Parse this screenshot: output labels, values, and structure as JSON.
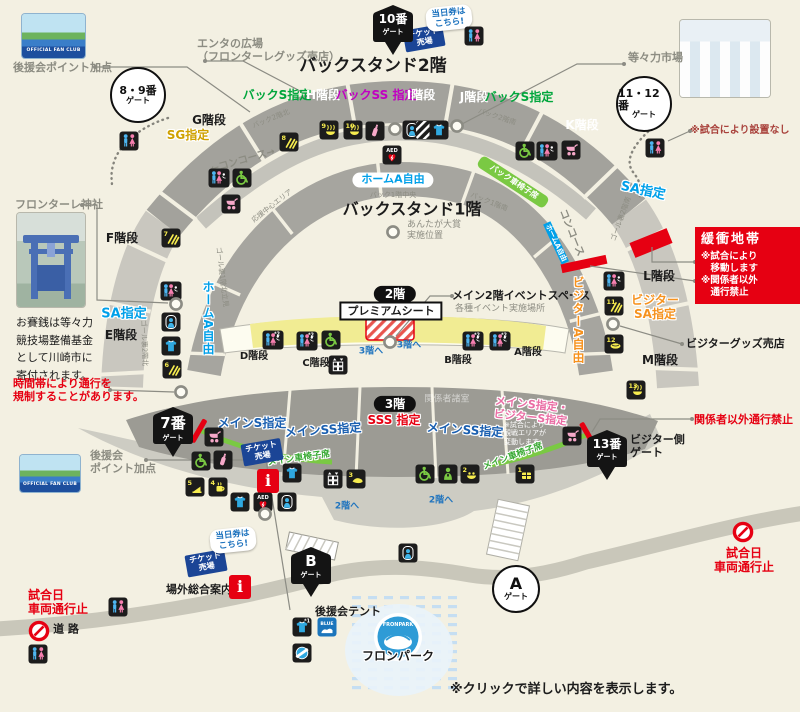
{
  "colors": {
    "bg": "#f3f0e2",
    "gray": "#8c8c82",
    "black": "#1c1c1c",
    "red": "#e60012",
    "dred": "#a8403a",
    "green": "#00a63c",
    "wgreen": "#3aaa35",
    "mag": "#c100c1",
    "cyan": "#00a0e9",
    "orange": "#f6921e",
    "gold": "#cfa100",
    "blue": "#1a5fb0",
    "pink": "#ea6da4",
    "blue2": "#1e73be",
    "stand_gray": "#a3a29c",
    "stand_light": "#c9c7bf",
    "seat_yellow": "#f1ec93",
    "wheelchair_green": "#7ac943",
    "road": "#c9c7ba",
    "park_blue": "#c5def2"
  },
  "buffer": {
    "title": "緩衝地帯",
    "line1": "※試合により",
    "line2": "　移動します",
    "line3": "※関係者以外",
    "line4": "　通行禁止"
  },
  "photos": {
    "fanclub": "OFFICIAL FAN CLUB",
    "fronpark": "FRONPARK"
  },
  "gates": [
    {
      "shape": "shield",
      "l1": "10番",
      "l2": "ゲート",
      "x": 393,
      "y": 31
    },
    {
      "shape": "shield",
      "l1": "7番",
      "l2": "ゲート",
      "x": 173,
      "y": 433
    },
    {
      "shape": "shield",
      "l1": "13番",
      "l2": "ゲート",
      "x": 607,
      "y": 456
    },
    {
      "shape": "shield",
      "l1": "B",
      "l2": "ゲート",
      "x": 311,
      "y": 573
    },
    {
      "shape": "circle",
      "l1": "8・9番",
      "l2": "ゲート",
      "x": 138,
      "y": 95,
      "r": 26
    },
    {
      "shape": "circle",
      "l1": "11・12番",
      "l2": "ゲート",
      "x": 644,
      "y": 104,
      "r": 26
    },
    {
      "shape": "circle",
      "l1": "A",
      "l2": "ゲート",
      "x": 516,
      "y": 589,
      "r": 22
    }
  ],
  "labels": [
    {
      "t": "エンタの広場\n（フロンターレグッズ売店）",
      "x": 197,
      "y": 38,
      "cls": "gray s11 b tl",
      "n": "enta-plaza-label"
    },
    {
      "t": "後援会ポイント加点",
      "x": 13,
      "y": 62,
      "cls": "gray s11 b tl",
      "n": "fanclub-point-label"
    },
    {
      "t": "後援会\nポイント加点",
      "x": 90,
      "y": 450,
      "cls": "gray s11 b tl",
      "n": "fanclub-point-label"
    },
    {
      "t": "バックスタンド2階",
      "x": 373,
      "y": 66,
      "cls": "black s17 b",
      "n": "backstand-2f-title"
    },
    {
      "t": "バックスタンド1階",
      "x": 412,
      "y": 210,
      "cls": "black s16 b",
      "n": "backstand-1f-title"
    },
    {
      "t": "バックS指定",
      "x": 277,
      "y": 95,
      "cls": "green s12 b",
      "n": "seat-back-s"
    },
    {
      "t": "H階段",
      "x": 323,
      "y": 95,
      "cls": "white s12 b",
      "n": "stairs-h"
    },
    {
      "t": "バックSS 指定",
      "x": 376,
      "y": 95,
      "cls": "mag s12 b",
      "n": "seat-back-ss"
    },
    {
      "t": "I階段",
      "x": 421,
      "y": 95,
      "cls": "white s12 b",
      "n": "stairs-i"
    },
    {
      "t": "J階段",
      "x": 474,
      "y": 97,
      "cls": "white s12 b",
      "n": "stairs-j"
    },
    {
      "t": "バックS指定",
      "x": 519,
      "y": 97,
      "cls": "green s12 b",
      "n": "seat-back-s"
    },
    {
      "t": "G階段",
      "x": 209,
      "y": 120,
      "cls": "black s12 b",
      "n": "stairs-g"
    },
    {
      "t": "SG指定",
      "x": 188,
      "y": 135,
      "cls": "gold s12 b halo",
      "n": "seat-sg"
    },
    {
      "t": "K階段",
      "x": 582,
      "y": 125,
      "cls": "white s12 b",
      "n": "stairs-k"
    },
    {
      "t": "F階段",
      "x": 122,
      "y": 238,
      "cls": "black s12 b",
      "n": "stairs-f"
    },
    {
      "t": "E階段",
      "x": 121,
      "y": 335,
      "cls": "black s12 b",
      "n": "stairs-e"
    },
    {
      "t": "SA指定",
      "x": 124,
      "y": 314,
      "cls": "cyan s13 b halo",
      "n": "seat-sa"
    },
    {
      "t": "SA指定",
      "x": 643,
      "y": 191,
      "cls": "cyan s13 b halo",
      "r": 12,
      "n": "seat-sa"
    },
    {
      "t": "L階段",
      "x": 659,
      "y": 276,
      "cls": "black s12 b",
      "n": "stairs-l"
    },
    {
      "t": "ビジター\nSA指定",
      "x": 655,
      "y": 307,
      "cls": "orange s12 b halo",
      "n": "seat-visitor-sa"
    },
    {
      "t": "M階段",
      "x": 660,
      "y": 360,
      "cls": "black s12 b",
      "n": "stairs-m"
    },
    {
      "t": "ビジターグッズ売店",
      "x": 686,
      "y": 338,
      "cls": "black s11 b tl",
      "n": "visitor-goods-shop-label"
    },
    {
      "t": "等々力市場",
      "x": 628,
      "y": 52,
      "cls": "gray s11 b tl",
      "n": "todoroki-market-label"
    },
    {
      "t": "※試合により設置なし",
      "x": 690,
      "y": 125,
      "cls": "dred s10 b tl",
      "n": "note-no-setup"
    },
    {
      "t": "フロンターレ神社",
      "x": 15,
      "y": 199,
      "cls": "gray s11 b tl",
      "n": "frontale-shrine-label"
    },
    {
      "t": "お賽銭は等々力\n競技場整備基金\nとして川崎市に\n寄付されます。",
      "x": 16,
      "y": 314,
      "cls": "black s11 tl lh16",
      "n": "shrine-donation-note"
    },
    {
      "t": "時間帯により通行を\n規制することがあります。",
      "x": 13,
      "y": 378,
      "cls": "red s11 b tl",
      "n": "traffic-restriction-note"
    },
    {
      "t": "あんたが大賞\n実施位置",
      "x": 407,
      "y": 220,
      "cls": "gray s9 tl",
      "n": "anta-taisho-label"
    },
    {
      "t": "ホームA自由",
      "x": 393,
      "y": 180,
      "cls": "cyan s11 b pill",
      "n": "seat-home-a-free"
    },
    {
      "t": "バック1階中央",
      "x": 393,
      "y": 195,
      "cls": "gray s7",
      "n": "area-back1f-center"
    },
    {
      "t": "バック2階北",
      "x": 271,
      "y": 119,
      "cls": "gray s7",
      "r": -22,
      "n": "area-back2f-north"
    },
    {
      "t": "バック2階南",
      "x": 497,
      "y": 117,
      "cls": "gray s7",
      "r": 18,
      "n": "area-back2f-south"
    },
    {
      "t": "バック1階南",
      "x": 489,
      "y": 202,
      "cls": "gray s7",
      "r": 22,
      "n": "area-back1f-south"
    },
    {
      "t": "応援中心エリア",
      "x": 272,
      "y": 206,
      "cls": "gray s7",
      "r": -38,
      "n": "area-cheering"
    },
    {
      "t": "ゴール裏1階北立見",
      "x": 222,
      "y": 277,
      "cls": "gray s7",
      "r": 83,
      "n": "area-goal-north"
    },
    {
      "t": "ゴール裏2階北",
      "x": 144,
      "y": 343,
      "cls": "gray s7",
      "r": 88,
      "n": "area-goal-2f-north"
    },
    {
      "t": "ゴール裏2階南",
      "x": 621,
      "y": 219,
      "cls": "gray s7",
      "r": -70,
      "n": "area-goal-2f-south"
    },
    {
      "t": "←コンコース→",
      "x": 243,
      "y": 161,
      "cls": "gray s10 b",
      "r": -16,
      "n": "concourse-label"
    },
    {
      "t": "コンコース",
      "x": 571,
      "y": 233,
      "cls": "gray s10 b",
      "r": 68,
      "n": "concourse-label"
    },
    {
      "t": "バック車椅子席",
      "x": 514,
      "y": 182,
      "cls": "white s8 b",
      "r": 33,
      "n": "seat-back-wheelchair"
    },
    {
      "t": "2階",
      "x": 395,
      "y": 294,
      "cls": "s12 b pillblack",
      "n": "floor-2f-badge"
    },
    {
      "t": "プレミアムシート",
      "x": 391,
      "y": 311,
      "cls": "black s11 b boxwhite",
      "n": "premium-seat-label"
    },
    {
      "t": "メイン2階イベントスペース",
      "x": 452,
      "y": 290,
      "cls": "black s11 b tl",
      "n": "main2f-event-space-label"
    },
    {
      "t": "各種イベント実施場所",
      "x": 455,
      "y": 304,
      "cls": "gray s9 tl",
      "n": "event-place-note"
    },
    {
      "t": "D階段",
      "x": 254,
      "y": 357,
      "cls": "black s10 b",
      "n": "stairs-d"
    },
    {
      "t": "C階段",
      "x": 316,
      "y": 364,
      "cls": "black s10 b",
      "n": "stairs-c"
    },
    {
      "t": "B階段",
      "x": 458,
      "y": 361,
      "cls": "black s10 b",
      "n": "stairs-b"
    },
    {
      "t": "A階段",
      "x": 528,
      "y": 353,
      "cls": "black s10 b",
      "n": "stairs-a"
    },
    {
      "t": "3階へ",
      "x": 371,
      "y": 352,
      "cls": "blue2 s9 b",
      "n": "to-3f-label"
    },
    {
      "t": "3階へ",
      "x": 409,
      "y": 346,
      "cls": "blue2 s9 b",
      "n": "to-3f-label"
    },
    {
      "t": "3階",
      "x": 395,
      "y": 404,
      "cls": "s12 b pillblack",
      "n": "floor-3f-badge"
    },
    {
      "t": "関係者諸室",
      "x": 447,
      "y": 400,
      "cls": "white s9 fade",
      "n": "staff-rooms-label"
    },
    {
      "t": "メインS指定",
      "x": 252,
      "y": 423,
      "cls": "blue s12 b halo",
      "n": "seat-main-s"
    },
    {
      "t": "メインSS指定",
      "x": 323,
      "y": 430,
      "cls": "blue s12 b halo",
      "r": -4,
      "n": "seat-main-ss"
    },
    {
      "t": "SSS 指定",
      "x": 394,
      "y": 420,
      "cls": "red s12 b halo",
      "n": "seat-sss"
    },
    {
      "t": "メインSS指定",
      "x": 465,
      "y": 430,
      "cls": "blue s12 b halo",
      "r": 4,
      "n": "seat-main-ss"
    },
    {
      "t": "メインS指定・\nビジターS指定",
      "x": 531,
      "y": 412,
      "cls": "pink s11 b halo",
      "r": 6,
      "n": "seat-main-s-visitor-s"
    },
    {
      "t": "※試合により\n観戦エリアが\n変動します。",
      "x": 504,
      "y": 421,
      "cls": "white s7 tl",
      "n": "note-area-changes"
    },
    {
      "t": "メイン車椅子席",
      "x": 299,
      "y": 459,
      "cls": "wgreen s9 b halo",
      "r": -8,
      "n": "seat-main-wheelchair"
    },
    {
      "t": "メイン車椅子席",
      "x": 513,
      "y": 457,
      "cls": "wgreen s9 b halo",
      "r": -20,
      "n": "seat-main-wheelchair"
    },
    {
      "t": "関係者以外通行禁止",
      "x": 694,
      "y": 414,
      "cls": "red s11 b tl",
      "n": "staff-only-note"
    },
    {
      "t": "ビジター側\nゲート",
      "x": 630,
      "y": 434,
      "cls": "black s11 b tl",
      "n": "visitor-gate-label"
    },
    {
      "t": "2階へ",
      "x": 347,
      "y": 507,
      "cls": "blue2 s9 b",
      "n": "to-2f-label"
    },
    {
      "t": "2階へ",
      "x": 441,
      "y": 501,
      "cls": "blue2 s9 b",
      "n": "to-2f-label"
    },
    {
      "t": "場外総合案内所",
      "x": 166,
      "y": 584,
      "cls": "black s11 b tl",
      "n": "info-center-label"
    },
    {
      "t": "後援会テント",
      "x": 315,
      "y": 606,
      "cls": "black s11 b tl",
      "n": "fanclub-tent-label"
    },
    {
      "t": "フロンパーク",
      "x": 398,
      "y": 656,
      "cls": "black s12 b halo",
      "n": "fronpark-label"
    },
    {
      "t": "FRONPARK",
      "x": 398,
      "y": 626,
      "cls": "white s5 b",
      "n": "fronpark-logo-text"
    },
    {
      "t": "※クリックで詳しい内容を表示します。",
      "x": 450,
      "y": 682,
      "cls": "black s13 b tl",
      "n": "click-note"
    },
    {
      "t": "試合日\n車両通行止",
      "x": 28,
      "y": 588,
      "cls": "red s12 b tl",
      "n": "matchday-road-closed"
    },
    {
      "t": "試合日\n車両通行止",
      "x": 744,
      "y": 560,
      "cls": "red s12 b",
      "n": "matchday-road-closed"
    },
    {
      "t": "道 路",
      "x": 66,
      "y": 630,
      "cls": "black s11 b",
      "n": "road-label"
    },
    {
      "t": "ホームA自由",
      "x": 208,
      "y": 318,
      "cls": "cyan s12 b vert halo",
      "n": "seat-home-a-free-side"
    },
    {
      "t": "ビジターA自由",
      "x": 578,
      "y": 320,
      "cls": "orange s12 b vert halo",
      "n": "seat-visitor-a-free-side"
    },
    {
      "t": "ホームA自由",
      "x": 556,
      "y": 243,
      "cls": "s7 b tagcyan",
      "r": 65,
      "n": "seat-home-a-free-tag"
    },
    {
      "t": "チケット\n売場",
      "x": 424,
      "y": 38,
      "cls": "badge-ticket",
      "r": -10,
      "n": "ticket-booth-badge"
    },
    {
      "t": "チケット\n売場",
      "x": 262,
      "y": 452,
      "cls": "badge-ticket",
      "r": -10,
      "n": "ticket-booth-badge"
    },
    {
      "t": "チケット\n売場",
      "x": 206,
      "y": 563,
      "cls": "badge-ticket",
      "r": -10,
      "n": "ticket-booth-badge"
    },
    {
      "t": "当日券は\nこちら!",
      "x": 449,
      "y": 18,
      "cls": "bubble",
      "r": -6,
      "n": "today-ticket-bubble"
    },
    {
      "t": "当日券は\nこちら!",
      "x": 233,
      "y": 540,
      "cls": "bubble",
      "r": -6,
      "n": "today-ticket-bubble"
    }
  ],
  "icons": [
    {
      "t": "toilet",
      "x": 474,
      "y": 36
    },
    {
      "t": "toilet",
      "x": 655,
      "y": 148
    },
    {
      "t": "toilet",
      "x": 129,
      "y": 141
    },
    {
      "t": "wc",
      "x": 219,
      "y": 178
    },
    {
      "t": "wheelchair",
      "x": 242,
      "y": 178
    },
    {
      "t": "stroller",
      "x": 231,
      "y": 204
    },
    {
      "t": "conc",
      "n": 7,
      "x": 171,
      "y": 238
    },
    {
      "t": "wc",
      "x": 171,
      "y": 291
    },
    {
      "t": "rescue",
      "x": 171,
      "y": 322
    },
    {
      "t": "shirt",
      "x": 171,
      "y": 346
    },
    {
      "t": "conc",
      "n": 6,
      "x": 172,
      "y": 369
    },
    {
      "t": "conc",
      "n": 8,
      "x": 289,
      "y": 142
    },
    {
      "t": "conc",
      "n": 9,
      "x": 329,
      "y": 130
    },
    {
      "t": "conc",
      "n": 10,
      "x": 353,
      "y": 130
    },
    {
      "t": "bottle",
      "x": 375,
      "y": 131
    },
    {
      "t": "rescue",
      "x": 412,
      "y": 130
    },
    {
      "t": "hatchsq",
      "x": 425,
      "y": 130
    },
    {
      "t": "shirt",
      "x": 439,
      "y": 130
    },
    {
      "t": "aed",
      "x": 392,
      "y": 155
    },
    {
      "t": "wheelchair",
      "x": 525,
      "y": 151
    },
    {
      "t": "wc",
      "x": 547,
      "y": 151
    },
    {
      "t": "stroller",
      "x": 571,
      "y": 150
    },
    {
      "t": "wc",
      "x": 614,
      "y": 281
    },
    {
      "t": "conc",
      "n": 11,
      "x": 614,
      "y": 306
    },
    {
      "t": "conc",
      "n": 12,
      "x": 614,
      "y": 344
    },
    {
      "t": "conc",
      "n": 13,
      "x": 636,
      "y": 390
    },
    {
      "t": "wc",
      "s": "2",
      "x": 273,
      "y": 340
    },
    {
      "t": "wc",
      "s": "2",
      "x": 307,
      "y": 341
    },
    {
      "t": "wheelchair",
      "x": 331,
      "y": 340
    },
    {
      "t": "locker",
      "x": 338,
      "y": 365
    },
    {
      "t": "wc",
      "s": "2",
      "x": 473,
      "y": 341
    },
    {
      "t": "wc",
      "s": "2",
      "x": 500,
      "y": 341
    },
    {
      "t": "stroller",
      "x": 214,
      "y": 437
    },
    {
      "t": "wheelchair",
      "x": 201,
      "y": 461
    },
    {
      "t": "bottle",
      "x": 223,
      "y": 460
    },
    {
      "t": "conc",
      "n": 5,
      "x": 195,
      "y": 487
    },
    {
      "t": "conc",
      "n": 4,
      "x": 218,
      "y": 487
    },
    {
      "t": "info",
      "x": 268,
      "y": 481
    },
    {
      "t": "shirt",
      "x": 292,
      "y": 473
    },
    {
      "t": "shirt",
      "x": 240,
      "y": 502
    },
    {
      "t": "aed",
      "x": 263,
      "y": 502
    },
    {
      "t": "rescue",
      "x": 287,
      "y": 502
    },
    {
      "t": "locker",
      "x": 333,
      "y": 479
    },
    {
      "t": "conc",
      "n": 3,
      "x": 356,
      "y": 479
    },
    {
      "t": "stroller",
      "x": 572,
      "y": 436
    },
    {
      "t": "wheelchair",
      "x": 425,
      "y": 474
    },
    {
      "t": "security",
      "x": 448,
      "y": 474
    },
    {
      "t": "conc",
      "n": 2,
      "x": 470,
      "y": 474
    },
    {
      "t": "conc",
      "n": 1,
      "x": 525,
      "y": 474
    },
    {
      "t": "rescue",
      "x": 408,
      "y": 553
    },
    {
      "t": "toilet",
      "x": 118,
      "y": 607
    },
    {
      "t": "noentry",
      "x": 39,
      "y": 631
    },
    {
      "t": "toilet",
      "x": 38,
      "y": 654
    },
    {
      "t": "shirt",
      "s": "1",
      "x": 302,
      "y": 627
    },
    {
      "t": "bluetent",
      "x": 327,
      "y": 627
    },
    {
      "t": "drum",
      "x": 302,
      "y": 653
    },
    {
      "t": "noentry",
      "x": 743,
      "y": 532
    },
    {
      "t": "info",
      "x": 240,
      "y": 587
    },
    {
      "t": "ring",
      "x": 395,
      "y": 129
    },
    {
      "t": "ring",
      "x": 457,
      "y": 126
    },
    {
      "t": "ring",
      "x": 613,
      "y": 324
    },
    {
      "t": "ring",
      "x": 176,
      "y": 304
    },
    {
      "t": "ring",
      "x": 390,
      "y": 342
    },
    {
      "t": "ring",
      "x": 181,
      "y": 392
    },
    {
      "t": "ring",
      "x": 265,
      "y": 514
    },
    {
      "t": "ring",
      "x": 393,
      "y": 232
    },
    {
      "t": "redbar",
      "x": 199,
      "y": 431,
      "r": 30
    },
    {
      "t": "redbar",
      "x": 588,
      "y": 434,
      "r": -30
    }
  ],
  "lines": [
    [
      95,
      67,
      187,
      67,
      250,
      112
    ],
    [
      205,
      61,
      243,
      61,
      302,
      92
    ],
    [
      624,
      64,
      577,
      64,
      462,
      124
    ],
    [
      82,
      205,
      97,
      205,
      97,
      300,
      168,
      303
    ],
    [
      110,
      390,
      174,
      392
    ],
    [
      146,
      460,
      266,
      460,
      290,
      610
    ],
    [
      452,
      296,
      430,
      296,
      396,
      336
    ],
    [
      682,
      344,
      620,
      326
    ],
    [
      692,
      419,
      600,
      419,
      592,
      432
    ],
    [
      695,
      262,
      652,
      262,
      652,
      247
    ],
    [
      695,
      281,
      590,
      266
    ],
    [
      690,
      131,
      668,
      141
    ]
  ]
}
